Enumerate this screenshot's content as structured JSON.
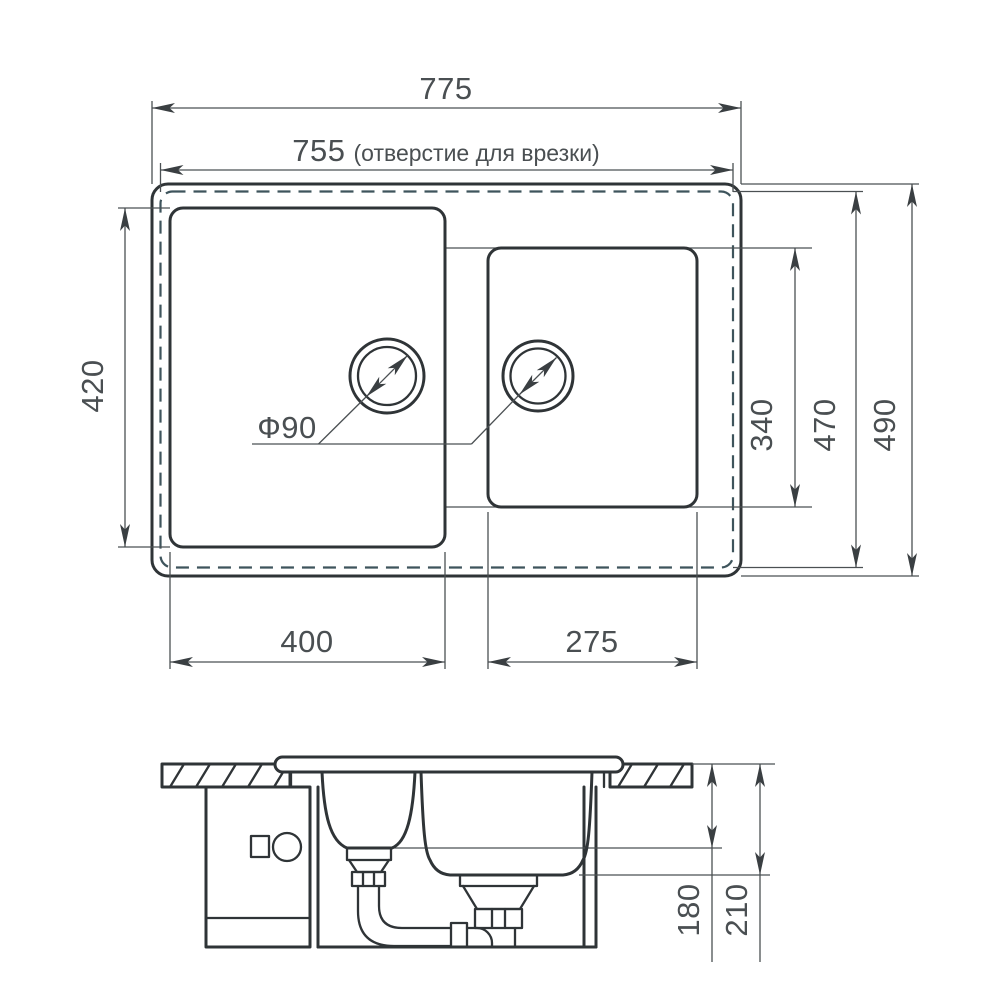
{
  "drawing": {
    "type_note": "kitchen sink installation drawing, two bowls, top view and section view"
  },
  "top_view": {
    "dim_overall_width": "775",
    "dim_cutout_width": "755",
    "cutout_note": "(отверстие для врезки)",
    "dim_left_bowl_height": "420",
    "dim_right_bowl_height": "340",
    "dim_cutout_height": "470",
    "dim_overall_height": "490",
    "dim_left_bowl_width": "400",
    "dim_right_bowl_width": "275",
    "drain_diameter_label": "Ф90"
  },
  "section_view": {
    "dim_small_bowl_depth": "180",
    "dim_large_bowl_depth": "210"
  },
  "colors": {
    "line_main": "#2f3437",
    "line_dim": "#4b5053",
    "cutout_dash": "#3e545c",
    "text": "#4a4f52",
    "background": "#ffffff"
  }
}
